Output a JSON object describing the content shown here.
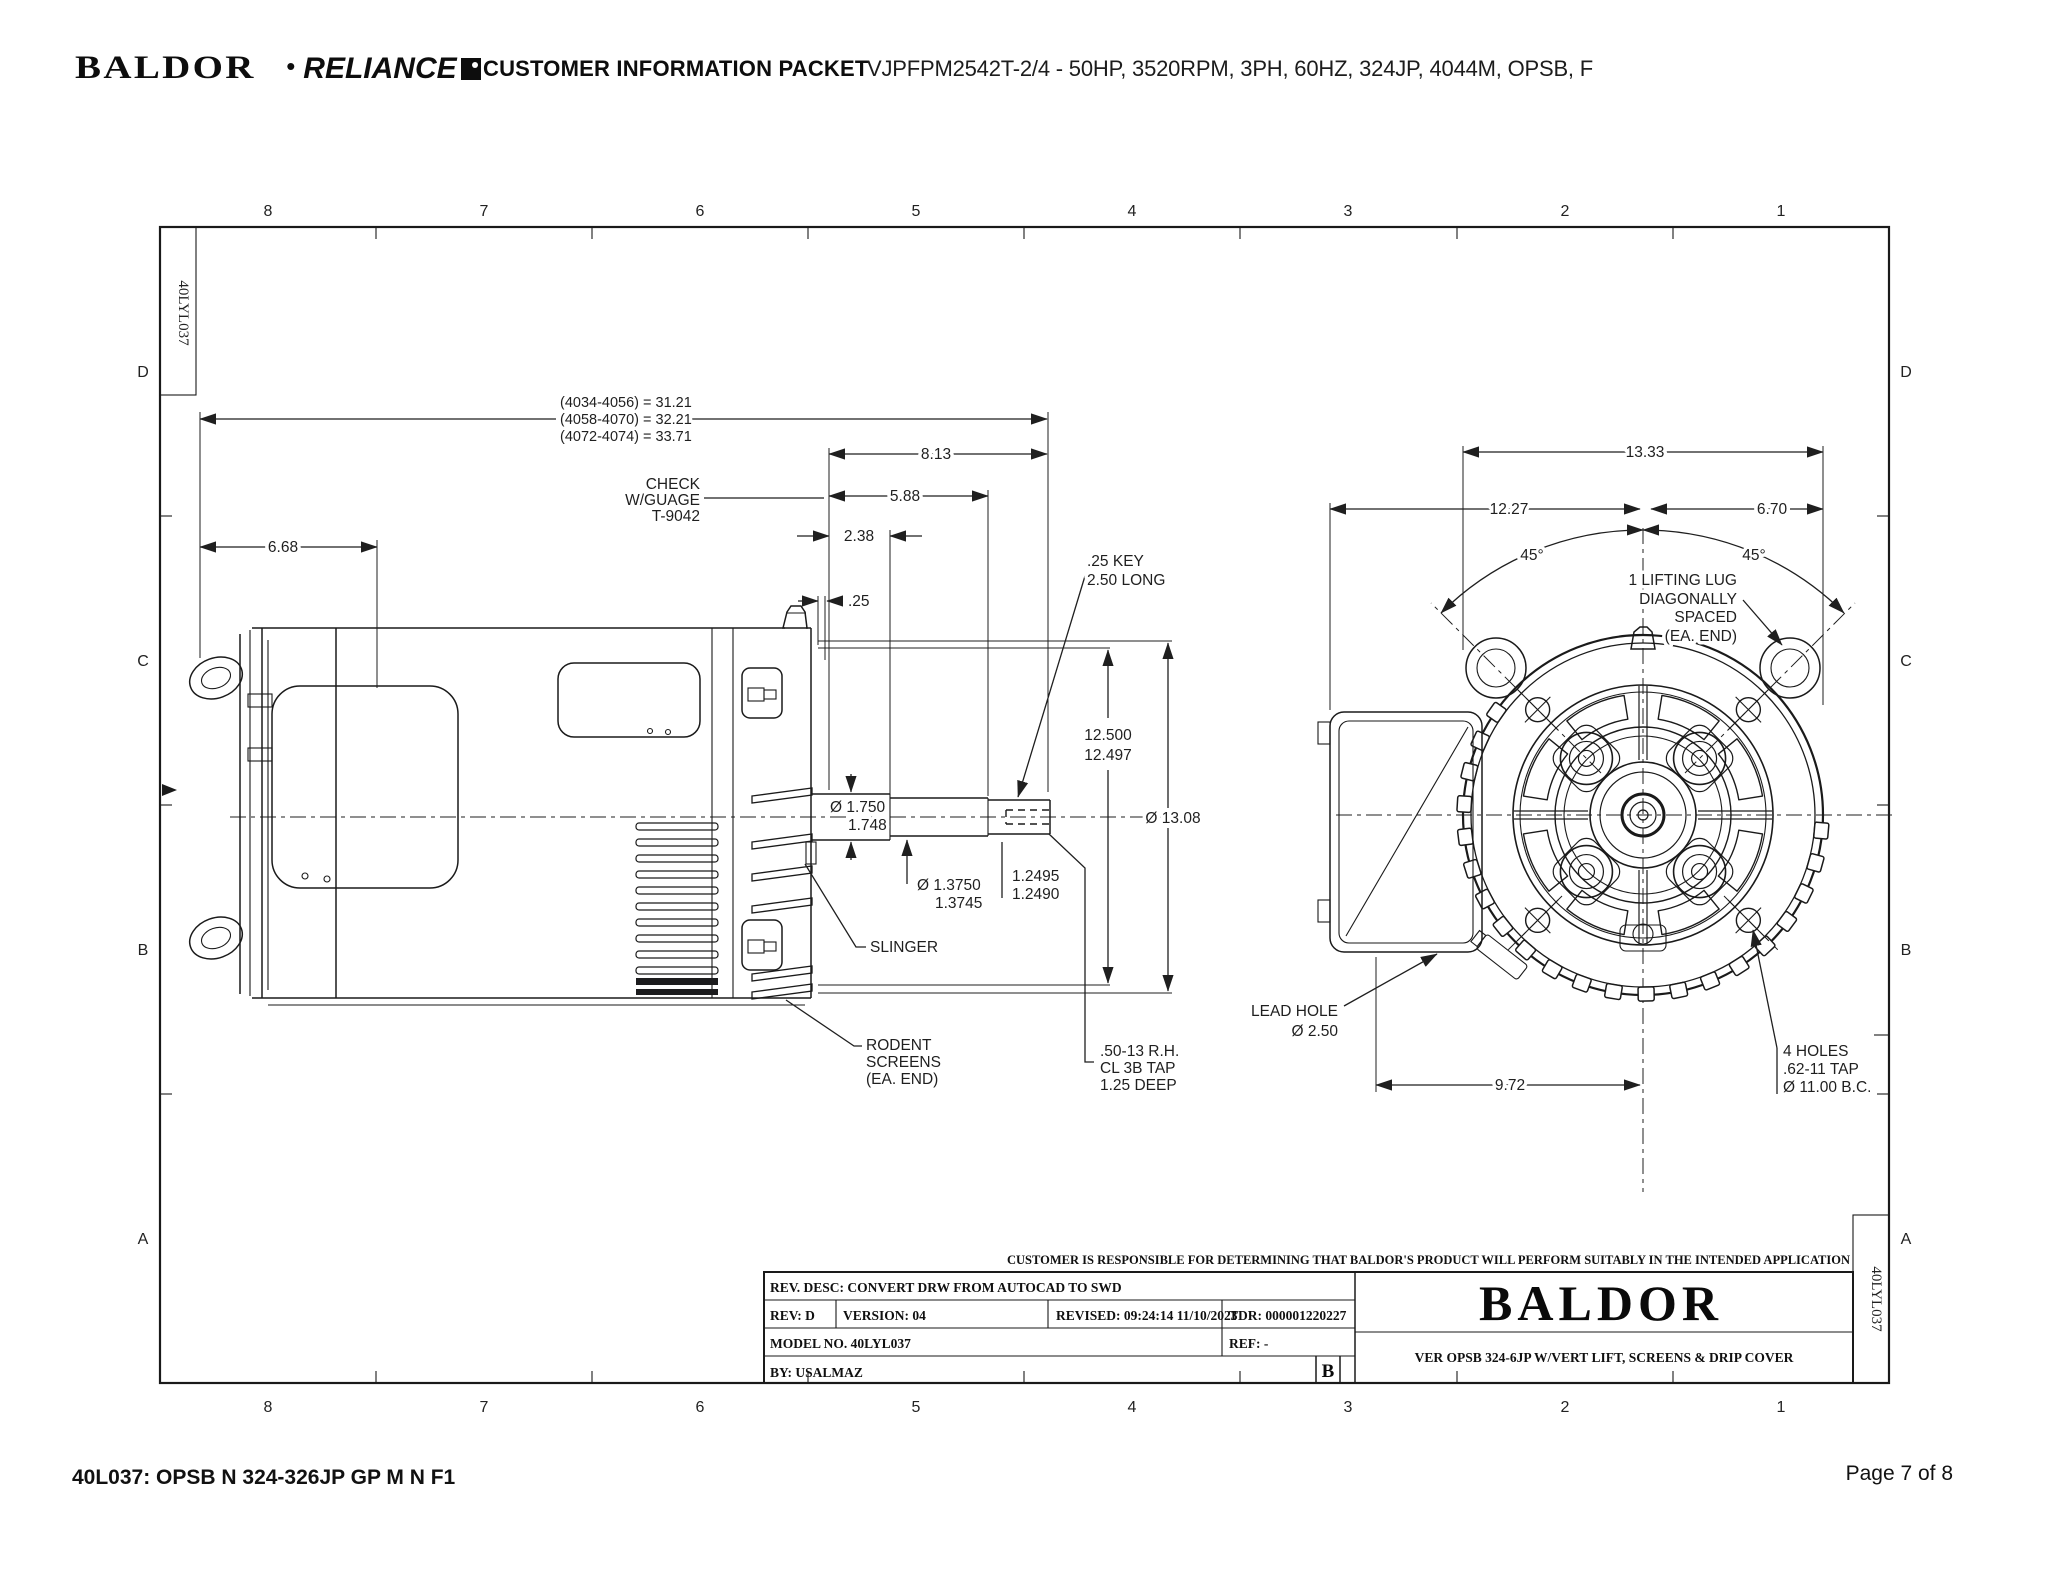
{
  "colors": {
    "ink": "#1a1a1a",
    "paper": "#ffffff"
  },
  "header": {
    "brand_baldor": "BALDOR",
    "brand_sep": "•",
    "brand_reliance": "RELIANCE",
    "title": "CUSTOMER INFORMATION PACKET",
    "model_line": "VJPFPM2542T-2/4 - 50HP, 3520RPM, 3PH, 60HZ, 324JP, 4044M, OPSB, F"
  },
  "footer": {
    "left": "40L037: OPSB N 324-326JP GP M N F1",
    "right": "Page 7 of 8"
  },
  "frame": {
    "cols": [
      "8",
      "7",
      "6",
      "5",
      "4",
      "3",
      "2",
      "1"
    ],
    "rows": [
      "D",
      "C",
      "B",
      "A"
    ],
    "doc_number": "40LYL037"
  },
  "side_view": {
    "stack": [
      "(4034-4056) = 31.21",
      "(4058-4070) = 32.21",
      "(4072-4074) = 33.71"
    ],
    "d813": "8.13",
    "d588": "5.88",
    "d238": "2.38",
    "d25": ".25",
    "d668": "6.68",
    "check": [
      "CHECK",
      "W/GUAGE",
      "T-9042"
    ],
    "key_note": [
      ".25 KEY",
      "2.50 LONG"
    ],
    "d125": [
      "12.500",
      "12.497"
    ],
    "d1308": "Ø 13.08",
    "d175": [
      "Ø 1.750",
      "1.748"
    ],
    "d1375": [
      "Ø 1.3750",
      "1.3745"
    ],
    "d12495": [
      "1.2495",
      "1.2490"
    ],
    "slinger": "SLINGER",
    "rodent": [
      "RODENT",
      "SCREENS",
      "(EA. END)"
    ],
    "tap": [
      ".50-13 R.H.",
      "CL 3B TAP",
      "1.25 DEEP"
    ]
  },
  "front_view": {
    "d1333": "13.33",
    "d1227": "12.27",
    "d670": "6.70",
    "a45_left": "45°",
    "a45_right": "45°",
    "lug_note": [
      "1 LIFTING LUG",
      "DIAGONALLY",
      "SPACED",
      "(EA. END)"
    ],
    "lead_hole": [
      "LEAD HOLE",
      "Ø 2.50"
    ],
    "d972": "9.72",
    "holes_note": [
      "4 HOLES",
      ".62-11 TAP",
      "Ø 11.00 B.C."
    ]
  },
  "title_block": {
    "disclaimer": "CUSTOMER IS RESPONSIBLE FOR DETERMINING THAT BALDOR'S PRODUCT WILL PERFORM SUITABLY IN THE INTENDED APPLICATION",
    "rev_desc": "REV. DESC: CONVERT DRW FROM AUTOCAD TO SWD",
    "rev": "REV:  D",
    "version": "VERSION:  04",
    "revised": "REVISED:  09:24:14 11/10/2023",
    "tdr": "TDR:  000001220227",
    "model_no": "MODEL NO.  40LYL037",
    "ref": "REF:  -",
    "by": "BY: USALMAZ",
    "size_letter": "B",
    "logo": "BALDOR",
    "description": "VER OPSB 324-6JP W/VERT LIFT, SCREENS & DRIP COVER"
  }
}
